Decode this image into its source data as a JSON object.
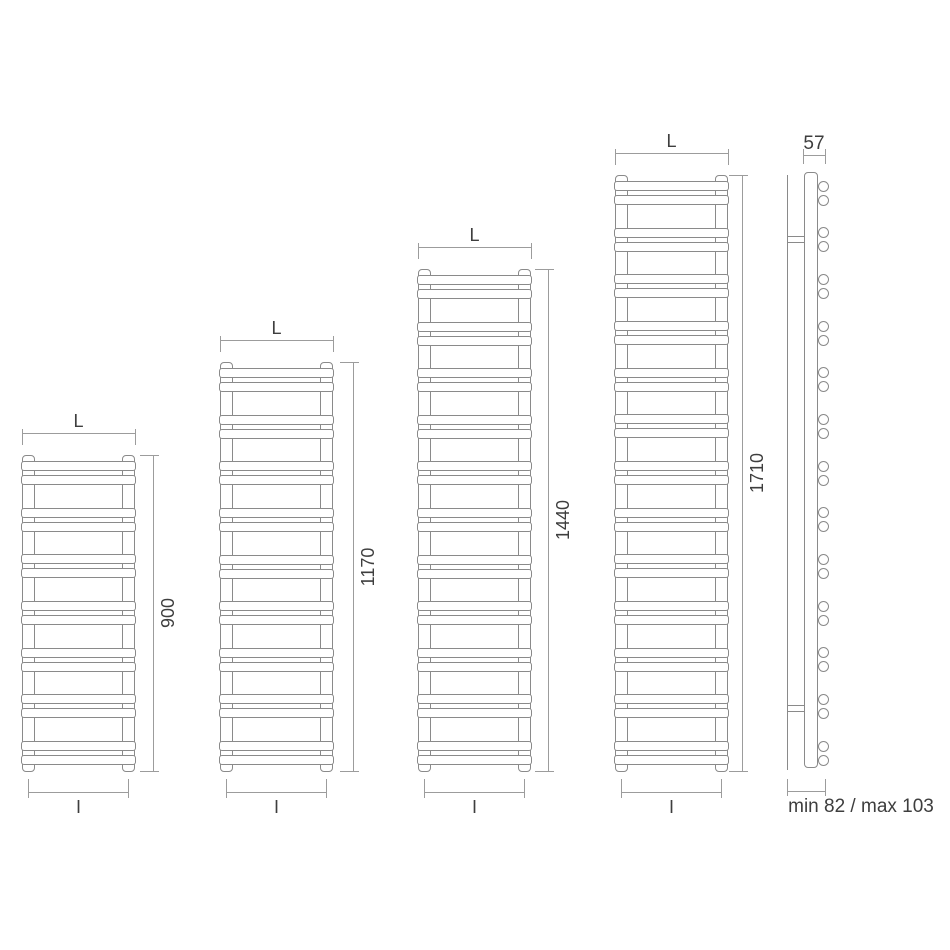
{
  "drawing_type": "towel-radiator-dimension-drawing",
  "radiators": [
    {
      "width_label": "L",
      "height_label": "900",
      "height_mm": 900,
      "interaxis_label": "I",
      "rung_pairs": 7
    },
    {
      "width_label": "L",
      "height_label": "1170",
      "height_mm": 1170,
      "interaxis_label": "I",
      "rung_pairs": 9
    },
    {
      "width_label": "L",
      "height_label": "1440",
      "height_mm": 1440,
      "interaxis_label": "I",
      "rung_pairs": 11
    },
    {
      "width_label": "L",
      "height_label": "1710",
      "height_mm": 1710,
      "interaxis_label": "I",
      "rung_pairs": 13
    }
  ],
  "side_view": {
    "depth_label": "57",
    "wall_distance_label": "min 82 / max 103",
    "rung_pairs": 13
  },
  "colors": {
    "line": "#8a8a8a",
    "dimension": "#9c9c9c",
    "text": "#3e3e3e",
    "background": "#ffffff"
  }
}
